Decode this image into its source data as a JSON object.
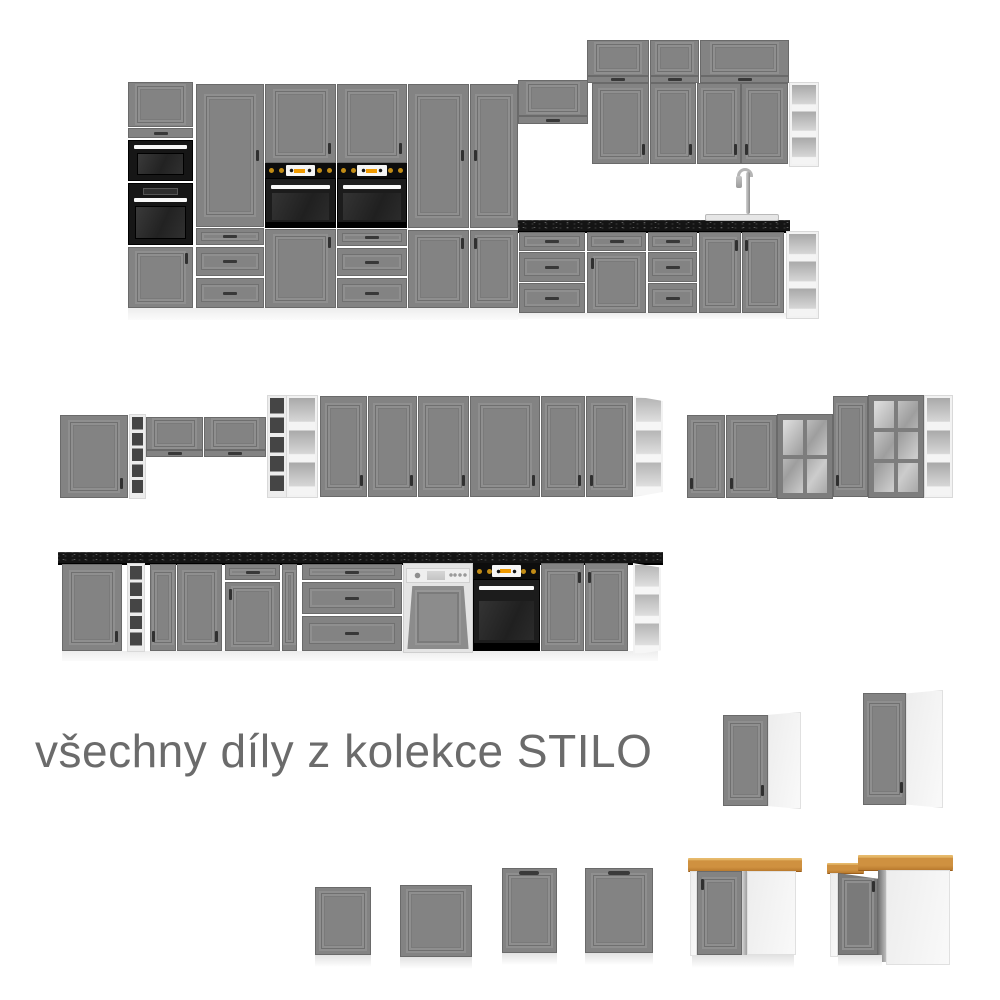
{
  "caption": {
    "text": "všechny díly z kolekce STILO"
  },
  "collection_name": "STILO",
  "colors": {
    "background": "#ffffff",
    "cabinet_gray": "#838383",
    "cabinet_frame_dark": "#6a6a6a",
    "countertop_black": "#141414",
    "worktop_oak": "#cf9140",
    "appliance_black": "#161616",
    "knob_gold": "#c28c16",
    "control_orange": "#f09a00",
    "carcass_white": "#f2f2f2",
    "caption_gray": "#6b6b6b"
  },
  "scene": {
    "groups": [
      {
        "id": "kitchen-run-top",
        "label": "tall kitchen run with ovens, sink and wall units"
      },
      {
        "id": "wall-cabinet-run-left",
        "label": "wall cabinets with wine racks and open shelves"
      },
      {
        "id": "wall-cabinet-run-center",
        "label": "six-door wall cabinet run"
      },
      {
        "id": "wall-cabinet-run-right",
        "label": "wall cabinets with glass doors"
      },
      {
        "id": "base-cabinet-run",
        "label": "base run with dishwasher and built-in oven"
      },
      {
        "id": "corner-wall-cabinet-small",
        "label": "corner wall cabinet"
      },
      {
        "id": "corner-wall-cabinet-large",
        "label": "corner wall cabinet tall"
      },
      {
        "id": "appliance-front-panels",
        "label": "four appliance front panels"
      },
      {
        "id": "corner-base-cabinet-blind",
        "label": "blind corner base cabinet with oak worktop"
      },
      {
        "id": "corner-base-cabinet-l",
        "label": "L-shaped corner base cabinet with oak worktop"
      }
    ]
  }
}
